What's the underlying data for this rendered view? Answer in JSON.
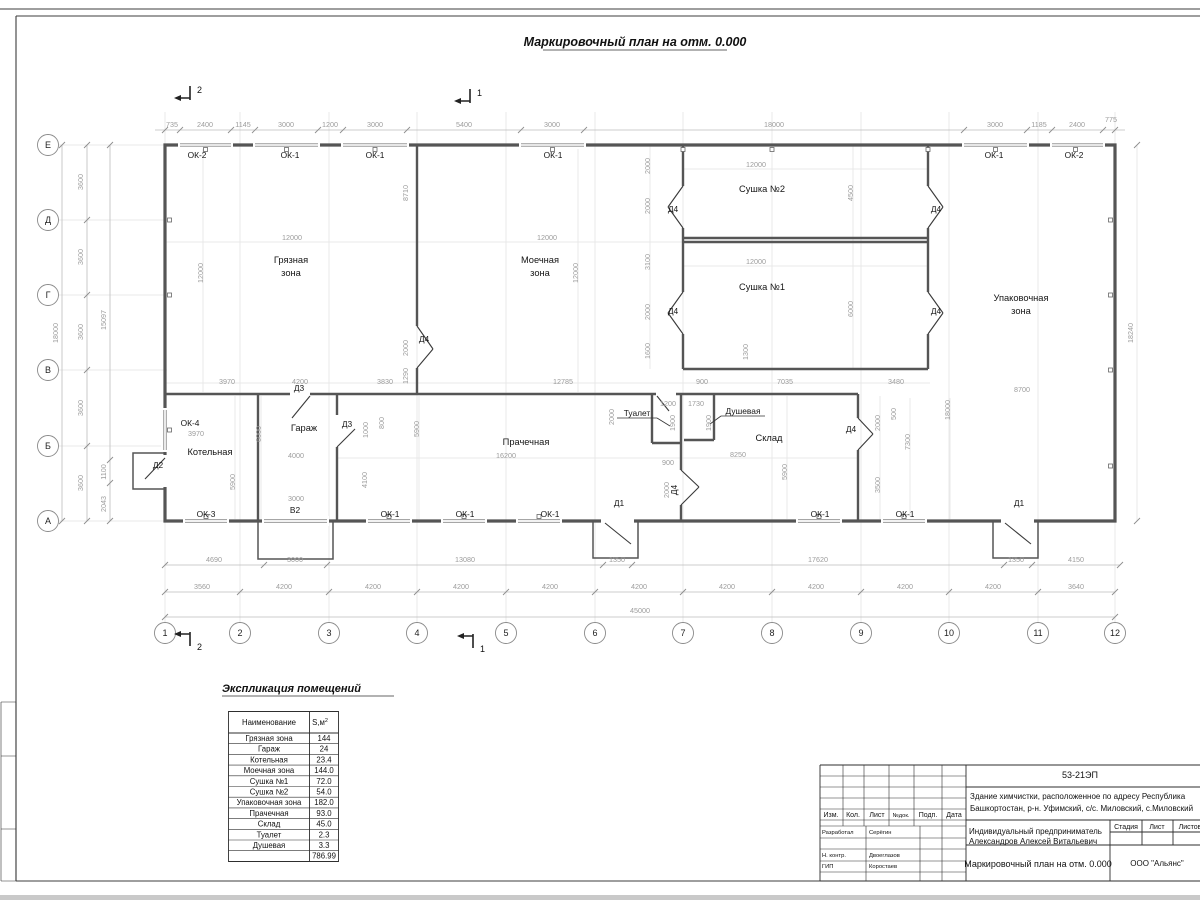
{
  "sheet": {
    "title": "Маркировочный план на отм. 0.000"
  },
  "axes": {
    "rows": [
      "Е",
      "Д",
      "Г",
      "В",
      "Б",
      "А"
    ],
    "cols": [
      "1",
      "2",
      "3",
      "4",
      "5",
      "6",
      "7",
      "8",
      "9",
      "10",
      "11",
      "12"
    ]
  },
  "sections": {
    "one": "1",
    "two": "2"
  },
  "rooms": {
    "dirty1": "Грязная",
    "dirty2": "зона",
    "wash1": "Моечная",
    "wash2": "зона",
    "dry2": "Сушка №2",
    "dry1": "Сушка №1",
    "pack1": "Упаковочная",
    "pack2": "зона",
    "boiler": "Котельная",
    "garage": "Гараж",
    "laundry": "Прачечная",
    "toilet": "Туалет",
    "shower": "Душевая",
    "storage": "Склад"
  },
  "openings": {
    "ok1": "ОК-1",
    "ok2": "ОК-2",
    "ok3": "ОК-3",
    "ok4": "ОК-4",
    "d1": "Д1",
    "d2": "Д2",
    "d3": "Д3",
    "d4": "Д4",
    "v2": "В2"
  },
  "dims": {
    "top": [
      "735",
      "2400",
      "1145",
      "3000",
      "1200",
      "3000",
      "5400",
      "3000",
      "18000",
      "3000",
      "1185",
      "2400",
      "775"
    ],
    "left_spans": [
      "3600",
      "3600",
      "3600",
      "3600",
      "3600"
    ],
    "left_total": "18000",
    "left_inner": [
      "15097",
      "1100",
      "2043"
    ],
    "right_total": "18240",
    "bottom1": [
      "4690",
      "3000",
      "13080",
      "1350",
      "17620",
      "1350",
      "4150"
    ],
    "bottom2": [
      "3560",
      "4200",
      "4200",
      "4200",
      "4200",
      "4200",
      "4200",
      "4200",
      "4200",
      "4200",
      "3640"
    ],
    "bottom_total": "45000",
    "inner": [
      "12000",
      "12000",
      "8710",
      "2000",
      "1290",
      "3970",
      "4200",
      "3830",
      "12000",
      "12000",
      "12785",
      "12000",
      "4500",
      "12000",
      "6000",
      "1300",
      "2000",
      "2000",
      "3100",
      "2000",
      "1600",
      "900",
      "7035",
      "3480",
      "8700",
      "3970",
      "6000",
      "5900",
      "4000",
      "1000",
      "800",
      "4100",
      "3000",
      "16200",
      "5900",
      "2000",
      "1200",
      "1730",
      "1900",
      "1900",
      "900",
      "2000",
      "8250",
      "5900",
      "2000",
      "500",
      "7300",
      "18000",
      "3500"
    ]
  },
  "explication": {
    "title": "Экспликация помещений",
    "header_name": "Наименование",
    "header_area": "S,м",
    "header_sup": "2",
    "rows": [
      [
        "Грязная зона",
        "144"
      ],
      [
        "Гараж",
        "24"
      ],
      [
        "Котельная",
        "23.4"
      ],
      [
        "Моечная зона",
        "144.0"
      ],
      [
        "Сушка №1",
        "72.0"
      ],
      [
        "Сушка №2",
        "54.0"
      ],
      [
        "Упаковочная зона",
        "182.0"
      ],
      [
        "Прачечная",
        "93.0"
      ],
      [
        "Склад",
        "45.0"
      ],
      [
        "Туалет",
        "2.3"
      ],
      [
        "Душевая",
        "3.3"
      ]
    ],
    "total": "786.99"
  },
  "titleblock": {
    "code": "53-21ЭП",
    "desc1": "Здание химчистки,  расположенное по адресу Республика",
    "desc2": "Башкортостан, р-н. Уфимский, с/с. Миловский, с.Миловский",
    "header_cells": [
      "Изм.",
      "Кол.",
      "Лист",
      "№док.",
      "Подп.",
      "Дата"
    ],
    "client1": "Индивидуальный предприниматель",
    "client2": "Александров Алексей Витальевич",
    "stage_cols": [
      "Стадия",
      "Лист",
      "Листов"
    ],
    "doc_title": "Маркировочный план на отм. 0.000",
    "org": "ООО \"Альянс\"",
    "roles": [
      [
        "Разработал",
        "Серёгин"
      ],
      [
        "Н. контр.",
        "Двоеглазов"
      ],
      [
        "ГИП",
        "Коростаев"
      ]
    ]
  }
}
